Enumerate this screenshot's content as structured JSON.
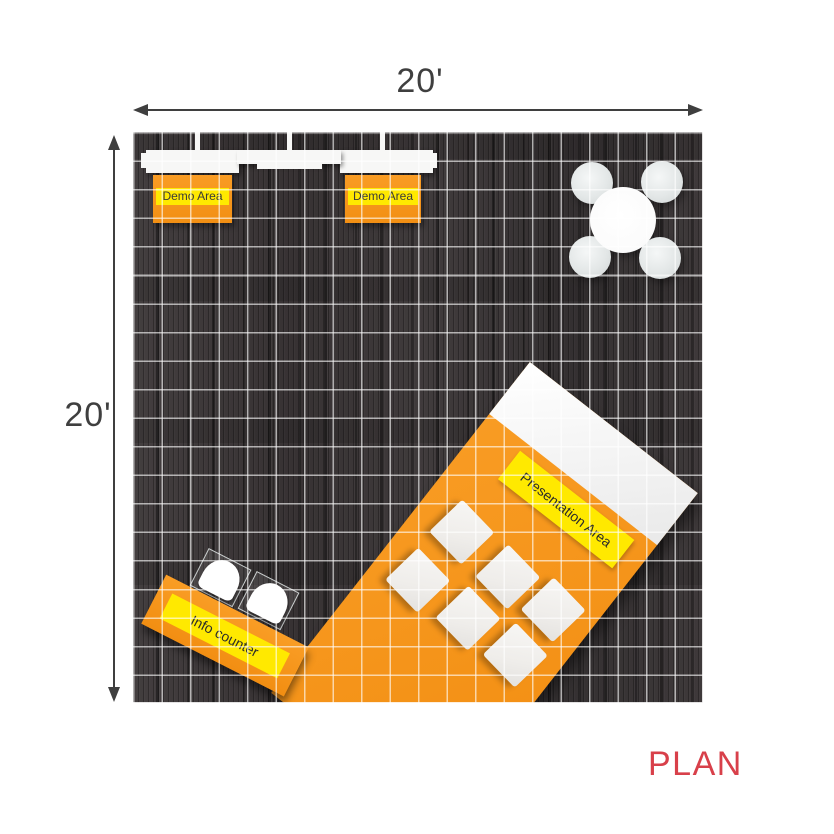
{
  "dimensions": {
    "width_label": "20'",
    "height_label": "20'"
  },
  "areas": {
    "demo_1": "Demo Area",
    "demo_2": "Demo Area",
    "presentation": "Presentation Area",
    "info": "Info counter"
  },
  "plan": {
    "label": "PLAN"
  },
  "colors": {
    "booth_orange": "#F7941E",
    "label_yellow": "#FFE900",
    "plan_red": "#D8404A",
    "floor_wood": "#3A3536",
    "grid_line": "#FFFFFF",
    "dimension_arrow": "#3F3F3F",
    "wall_white": "#F7F7F6"
  }
}
